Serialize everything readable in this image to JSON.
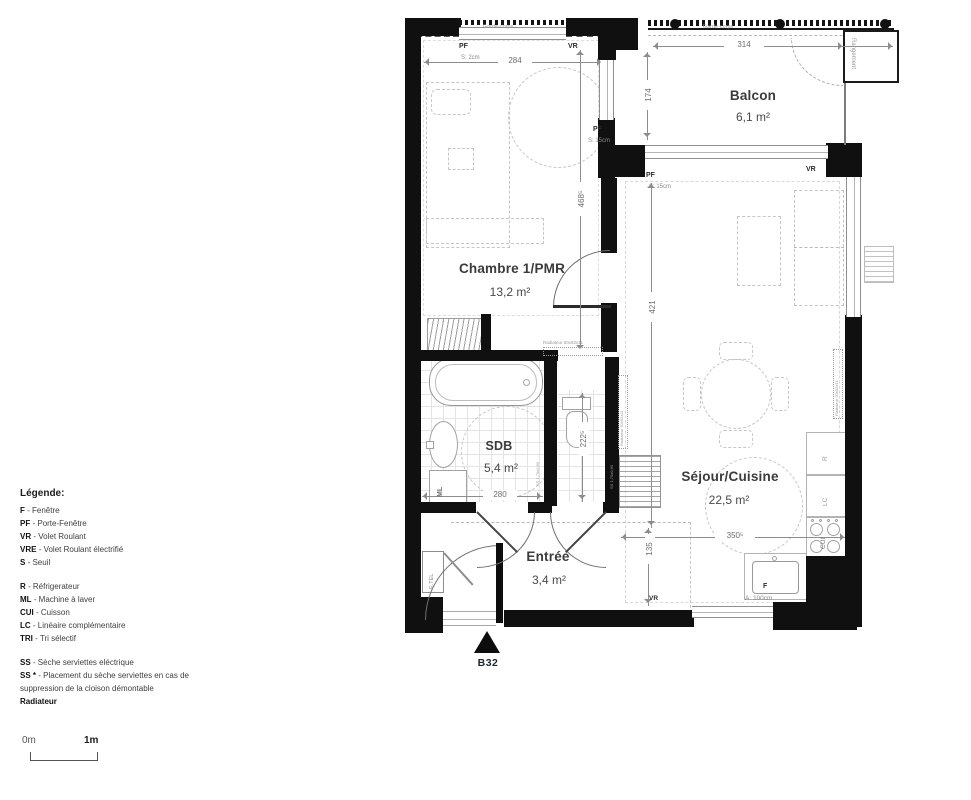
{
  "unit": {
    "code": "B32"
  },
  "rooms": {
    "chambre": {
      "name": "Chambre 1/PMR",
      "area": "13,2 m²"
    },
    "balcon": {
      "name": "Balcon",
      "area": "6,1 m²"
    },
    "sdb": {
      "name": "SDB",
      "area": "5,4 m²"
    },
    "entree": {
      "name": "Entrée",
      "area": "3,4 m²"
    },
    "sejour": {
      "name": "Séjour/Cuisine",
      "area": "22,5 m²"
    }
  },
  "dims": {
    "chambre_w": "284",
    "chambre_h": "468⁵",
    "balcon_w": "314",
    "balcon_h": "174",
    "sejour_h": "421",
    "sejour_w": "350⁵",
    "entree_h": "135",
    "sdb_w": "280",
    "wc_h": "222⁵"
  },
  "labels": {
    "garde_corps": "Garde-corps",
    "pf": "PF",
    "vr": "VR",
    "f": "F",
    "s2": "S: 2cm",
    "s15": "S: 15cm",
    "rangement": "Rangement",
    "ml": "ML",
    "etel": "E.TEL",
    "allege": "A: 100cm",
    "kitchen_r": "R",
    "kitchen_lc": "LC",
    "kitchen_cui": "CUI",
    "radiateur_tag": "Radiateur 50x92x11",
    "ss_tag": "SS 1,70x0,60"
  },
  "legend": {
    "title": "Légende:",
    "g1": [
      {
        "a": "F",
        "t": "- Fenêtre"
      },
      {
        "a": "PF",
        "t": "- Porte-Fenêtre"
      },
      {
        "a": "VR",
        "t": "- Volet Roulant"
      },
      {
        "a": "VRE",
        "t": "- Volet Roulant électrifié"
      },
      {
        "a": "S",
        "t": "- Seuil"
      }
    ],
    "g2": [
      {
        "a": "R",
        "t": "- Réfrigerateur"
      },
      {
        "a": "ML",
        "t": "- Machine à laver"
      },
      {
        "a": "CUI",
        "t": "- Cuisson"
      },
      {
        "a": "LC",
        "t": "- Linéaire complémentaire"
      },
      {
        "a": "TRI",
        "t": "- Tri sélectif"
      }
    ],
    "g3": [
      {
        "a": "SS",
        "t": "- Sèche serviettes eléctrique"
      },
      {
        "a": "SS *",
        "t": "- Placement du sèche serviettes en cas de suppression de la cloison démontable"
      }
    ],
    "footer": "Radiateur"
  },
  "scale": {
    "zero": "0m",
    "one": "1m"
  }
}
